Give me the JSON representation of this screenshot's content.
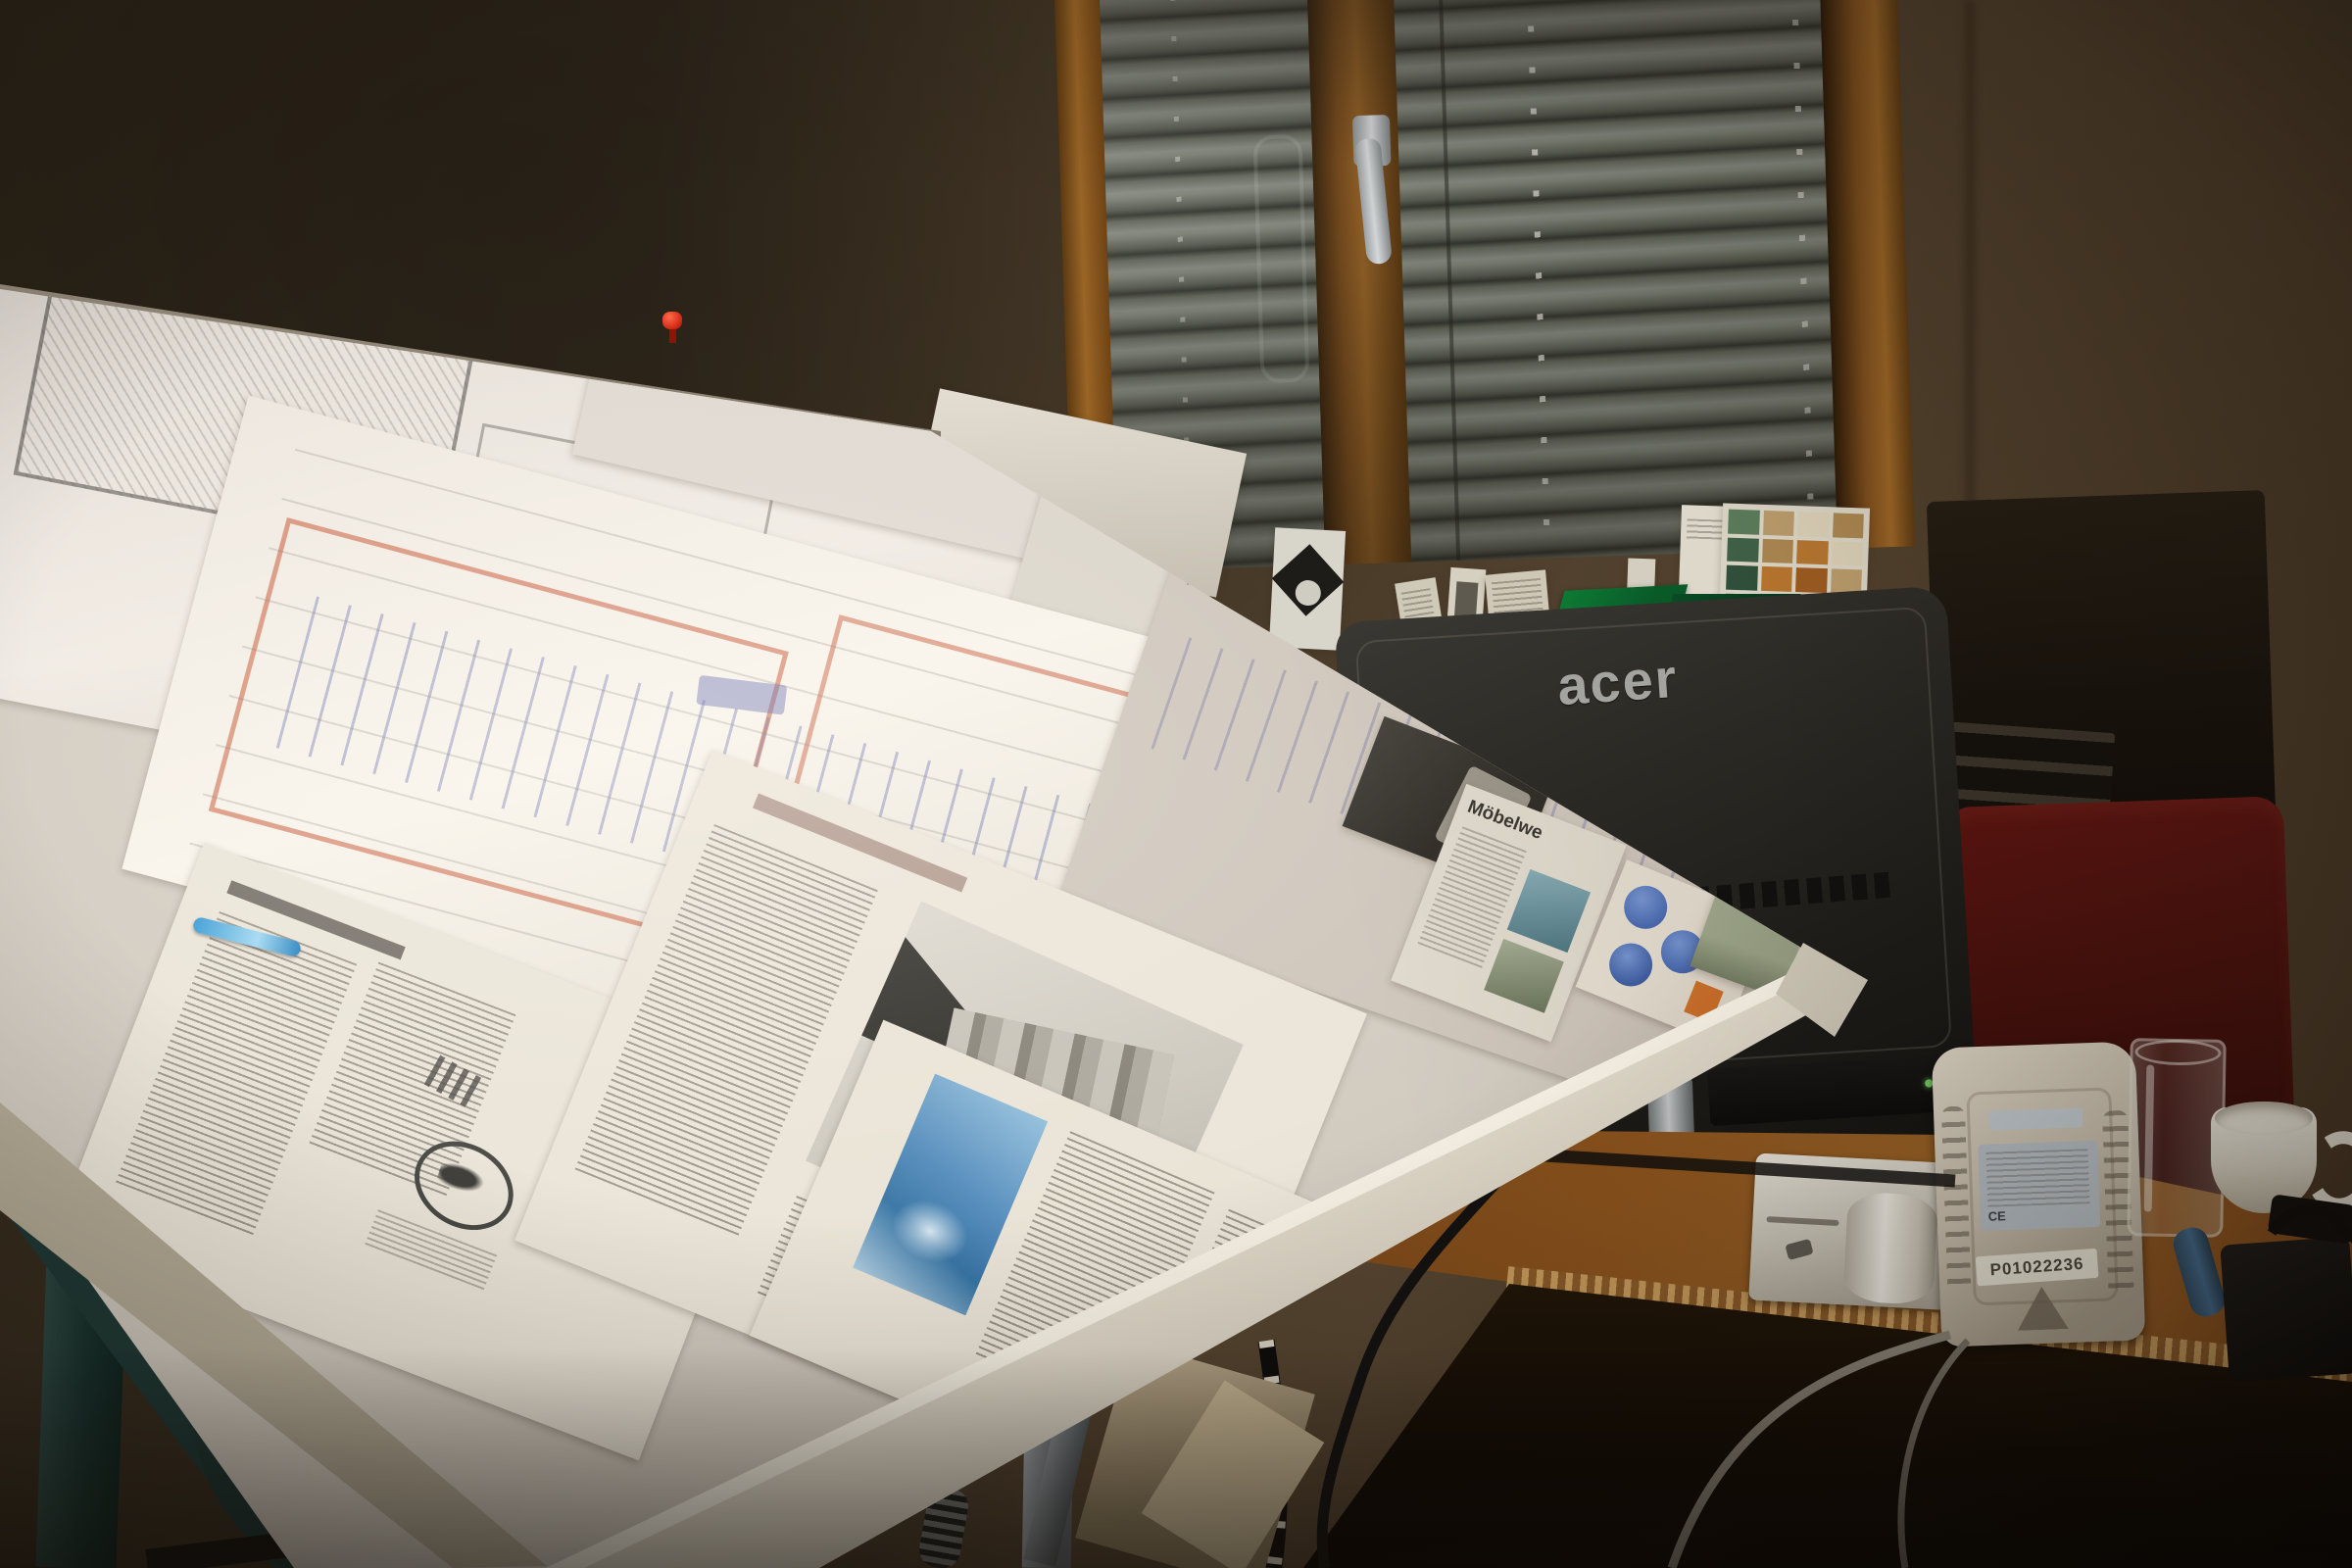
{
  "scene": {
    "type": "photograph",
    "description": "Dim architect home office: a large tilted drafting table covered with folded floor-plan sheets marked in red and blue, newspaper and magazine clippings along its lower rail, the rear of an Acer monitor, a window with venetian blinds in a wooden frame, and a wooden desk holding a small printer with paper roll, a beige power unit, a drinking glass and a white cup, with a dark red chair behind."
  },
  "monitor": {
    "brand_logo": "acer",
    "shell_color": "#28261f",
    "logo_color": "#a3a39f",
    "power_led_color": "#7ddc6a"
  },
  "window": {
    "blind_slat_color": "#8a8f80",
    "frame_color": "#8a5a22",
    "handle_color": "#c9cdd0"
  },
  "drafting_table": {
    "paper_color": "#efe9e0",
    "rail_color": "#e8e1d2",
    "pushpin_color": "#d8301a",
    "plan_line_colors": {
      "red": "#c0502a",
      "blue": "#4a5aa8",
      "pencil": "#6a675f"
    }
  },
  "clippings": {
    "magazine_headline_fragment": "Möbelwe",
    "badge_color": "#3a5fae",
    "accent_orange": "#cf6a1f",
    "photo_blue": "#4a85b8"
  },
  "device": {
    "serial_label": "P01022236",
    "body_color": "#cdc4b2",
    "spec_label_color": "#b9c2c8"
  },
  "desk": {
    "wood_color": "#8a521c"
  },
  "chair": {
    "color": "#5a1410"
  },
  "swatches": {
    "colors": [
      "#5a7a5a",
      "#3f5f46",
      "#2f4f3a",
      "#b89a6a",
      "#a9854f",
      "#b4742f",
      "#9a5a20",
      "#d8cdb4"
    ]
  }
}
